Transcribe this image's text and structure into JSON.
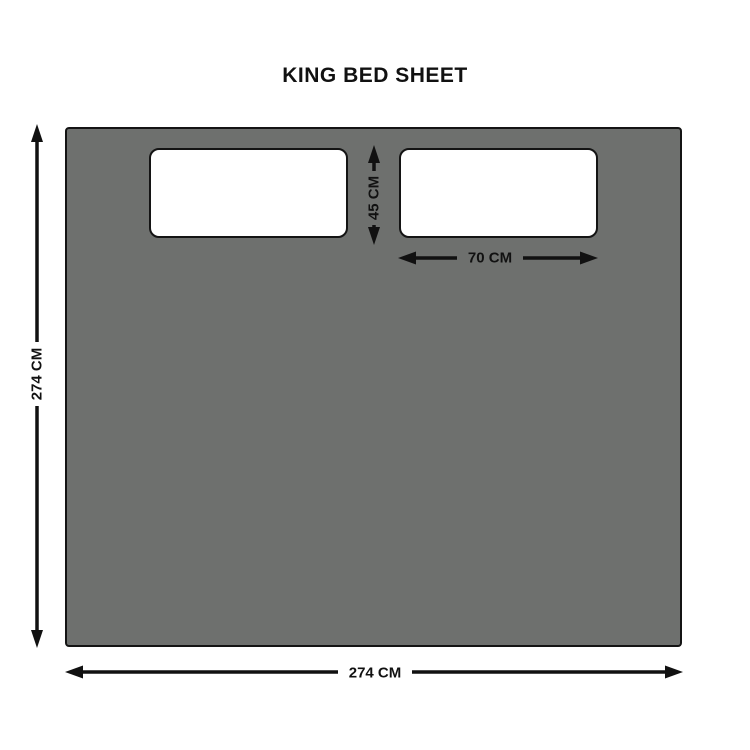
{
  "title": "KING BED SHEET",
  "sheet": {
    "name": "King bed sheet",
    "width_label": "274 CM",
    "height_label": "274 CM"
  },
  "pillow": {
    "width_label": "70 CM",
    "height_label": "45 CM"
  },
  "colors": {
    "background": "#ffffff",
    "sheet_fill": "#6e706e",
    "sheet_border": "#141414",
    "pillow_fill": "#ffffff",
    "pillow_border": "#141414",
    "dimension_line": "#111111",
    "text": "#111111"
  }
}
